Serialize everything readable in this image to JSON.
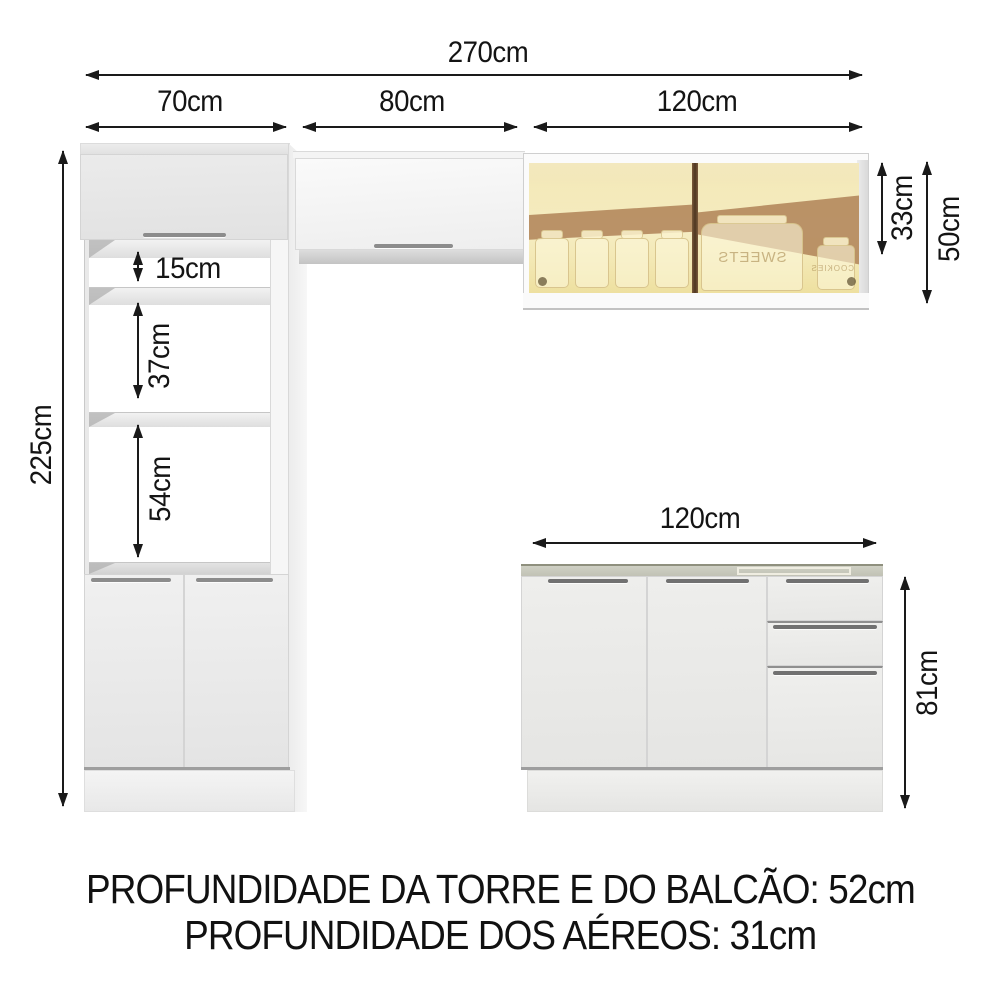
{
  "diagram": {
    "dimensions": {
      "total_width": "270cm",
      "tower_width": "70cm",
      "upper_cabinet_width": "80cm",
      "glass_cabinet_width": "120cm",
      "total_height": "225cm",
      "niche_top_height": "15cm",
      "niche_middle_height": "37cm",
      "niche_bottom_height": "54cm",
      "glass_door_height": "33cm",
      "glass_cabinet_height": "50cm",
      "counter_width": "120cm",
      "counter_height": "81cm"
    },
    "glass_cabinet": {
      "jar_label_left": "SWEETS",
      "jar_label_right": "COOKIES"
    },
    "footer": {
      "line1": "PROFUNDIDADE DA TORRE E DO BALCÃO: 52cm",
      "line2": "PROFUNDIDADE DOS AÉREOS: 31cm"
    },
    "colors": {
      "line": "#1a1a1a",
      "glass_amber": "#f0e3a8",
      "glass_reflection_band": "#b2855a",
      "counter_top": "#c9cabf"
    }
  }
}
